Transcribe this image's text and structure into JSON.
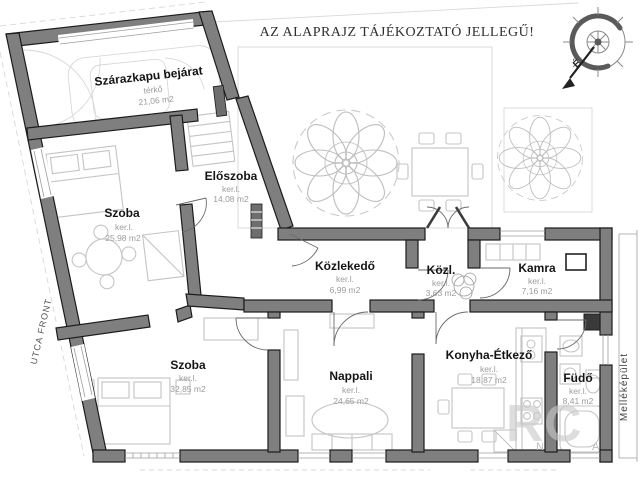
{
  "title": "AZ ALAPRAJZ TÁJÉKOZTATÓ JELLEGŰ!",
  "site": {
    "street_front": "UTCA FRONT",
    "outbuilding": "Melléképület"
  },
  "compass": {
    "north_label": "É"
  },
  "watermark": {
    "letters": [
      "R",
      "C",
      "N",
      "A"
    ]
  },
  "rooms": [
    {
      "name": "Szárazkapu bejárat",
      "surface": "térkő",
      "area": "21,06 m2"
    },
    {
      "name": "Előszoba",
      "surface": "ker.l.",
      "area": "14,08 m2"
    },
    {
      "name": "Szoba",
      "surface": "ker.l.",
      "area": "25,98 m2"
    },
    {
      "name": "Szoba",
      "surface": "ker.l.",
      "area": "32,85 m2"
    },
    {
      "name": "Közlekedő",
      "surface": "ker.l.",
      "area": "6,99 m2"
    },
    {
      "name": "Közl.",
      "surface": "ker.l.",
      "area": "3,63 m2"
    },
    {
      "name": "Kamra",
      "surface": "ker.l.",
      "area": "7,16 m2"
    },
    {
      "name": "Nappali",
      "surface": "ker.l.",
      "area": "24,65 m2"
    },
    {
      "name": "Konyha-Étkező",
      "surface": "ker.l.",
      "area": "18,87 m2"
    },
    {
      "name": "Füdő",
      "surface": "ker.l.",
      "area": "8,41 m2"
    }
  ],
  "colors": {
    "wall": "#7f7f7f",
    "wall_outline": "#1c1c1c",
    "furniture_line": "#c4c4c4",
    "label": "#141414",
    "sublabel": "#9c9c9c",
    "background": "#ffffff",
    "watermark": "#c9c9c9"
  }
}
